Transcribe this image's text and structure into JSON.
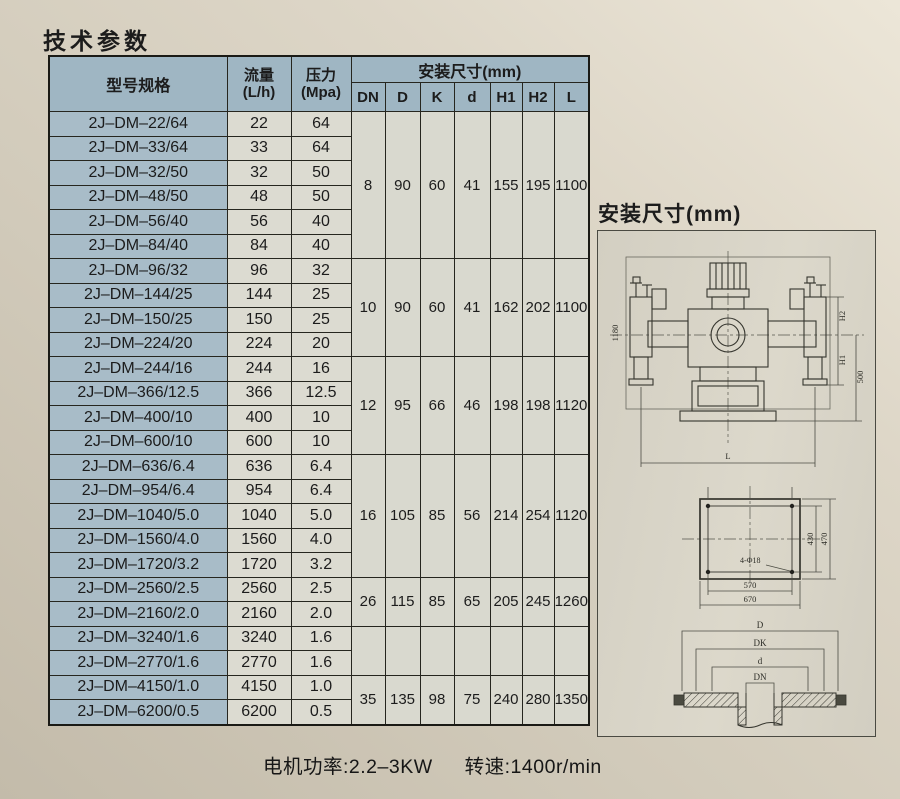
{
  "page": {
    "title": "技术参数"
  },
  "table": {
    "headers": {
      "model": "型号规格",
      "flow_l1": "流量",
      "flow_l2": "(L/h)",
      "pressure_l1": "压力",
      "pressure_l2": "(Mpa)",
      "install": "安装尺寸(mm)",
      "dims": [
        "DN",
        "D",
        "K",
        "d",
        "H1",
        "H2",
        "L"
      ]
    },
    "rows": [
      {
        "model": "2J–DM–22/64",
        "flow": "22",
        "pressure": "64"
      },
      {
        "model": "2J–DM–33/64",
        "flow": "33",
        "pressure": "64"
      },
      {
        "model": "2J–DM–32/50",
        "flow": "32",
        "pressure": "50"
      },
      {
        "model": "2J–DM–48/50",
        "flow": "48",
        "pressure": "50"
      },
      {
        "model": "2J–DM–56/40",
        "flow": "56",
        "pressure": "40"
      },
      {
        "model": "2J–DM–84/40",
        "flow": "84",
        "pressure": "40"
      },
      {
        "model": "2J–DM–96/32",
        "flow": "96",
        "pressure": "32"
      },
      {
        "model": "2J–DM–144/25",
        "flow": "144",
        "pressure": "25"
      },
      {
        "model": "2J–DM–150/25",
        "flow": "150",
        "pressure": "25"
      },
      {
        "model": "2J–DM–224/20",
        "flow": "224",
        "pressure": "20"
      },
      {
        "model": "2J–DM–244/16",
        "flow": "244",
        "pressure": "16"
      },
      {
        "model": "2J–DM–366/12.5",
        "flow": "366",
        "pressure": "12.5"
      },
      {
        "model": "2J–DM–400/10",
        "flow": "400",
        "pressure": "10"
      },
      {
        "model": "2J–DM–600/10",
        "flow": "600",
        "pressure": "10"
      },
      {
        "model": "2J–DM–636/6.4",
        "flow": "636",
        "pressure": "6.4"
      },
      {
        "model": "2J–DM–954/6.4",
        "flow": "954",
        "pressure": "6.4"
      },
      {
        "model": "2J–DM–1040/5.0",
        "flow": "1040",
        "pressure": "5.0"
      },
      {
        "model": "2J–DM–1560/4.0",
        "flow": "1560",
        "pressure": "4.0"
      },
      {
        "model": "2J–DM–1720/3.2",
        "flow": "1720",
        "pressure": "3.2"
      },
      {
        "model": "2J–DM–2560/2.5",
        "flow": "2560",
        "pressure": "2.5"
      },
      {
        "model": "2J–DM–2160/2.0",
        "flow": "2160",
        "pressure": "2.0"
      },
      {
        "model": "2J–DM–3240/1.6",
        "flow": "3240",
        "pressure": "1.6"
      },
      {
        "model": "2J–DM–2770/1.6",
        "flow": "2770",
        "pressure": "1.6"
      },
      {
        "model": "2J–DM–4150/1.0",
        "flow": "4150",
        "pressure": "1.0"
      },
      {
        "model": "2J–DM–6200/0.5",
        "flow": "6200",
        "pressure": "0.5"
      }
    ],
    "dim_groups": [
      {
        "span": 6,
        "values": [
          "8",
          "90",
          "60",
          "41",
          "155",
          "195",
          "1100"
        ]
      },
      {
        "span": 4,
        "values": [
          "10",
          "90",
          "60",
          "41",
          "162",
          "202",
          "1100"
        ]
      },
      {
        "span": 4,
        "values": [
          "12",
          "95",
          "66",
          "46",
          "198",
          "198",
          "1120"
        ]
      },
      {
        "span": 5,
        "values": [
          "16",
          "105",
          "85",
          "56",
          "214",
          "254",
          "1120"
        ]
      },
      {
        "span": 2,
        "values": [
          "26",
          "115",
          "85",
          "65",
          "205",
          "245",
          "1260"
        ]
      },
      {
        "span": 2,
        "values": [
          "",
          "",
          "",
          "",
          "",
          "",
          ""
        ]
      },
      {
        "span": 2,
        "values": [
          "35",
          "135",
          "98",
          "75",
          "240",
          "280",
          "1350"
        ]
      }
    ]
  },
  "diagram": {
    "title": "安装尺寸(mm)",
    "front_view": {
      "overall_height": "1180",
      "h2_label": "H2",
      "h1_label": "H1",
      "base_height": "500",
      "length_label": "L"
    },
    "plan_view": {
      "bolt_span_width": "570",
      "base_width": "670",
      "inner_depth": "430",
      "outer_depth": "470",
      "holes_note": "4-Φ18"
    },
    "flange_view": {
      "outer": "D",
      "bolt_circle": "DK",
      "raised_face": "d",
      "bore": "DN"
    }
  },
  "footer": {
    "motor_power": "电机功率:2.2–3KW",
    "speed": "转速:1400r/min"
  },
  "colors": {
    "header_bg": "#9fb6c3",
    "model_bg": "#a8bcc8",
    "value_bg": "#dcdbd1",
    "dim_bg": "#d9d9cf",
    "table_border": "#26261f",
    "page_bg": "#d6cfc0",
    "drawing_line": "#35352e"
  }
}
